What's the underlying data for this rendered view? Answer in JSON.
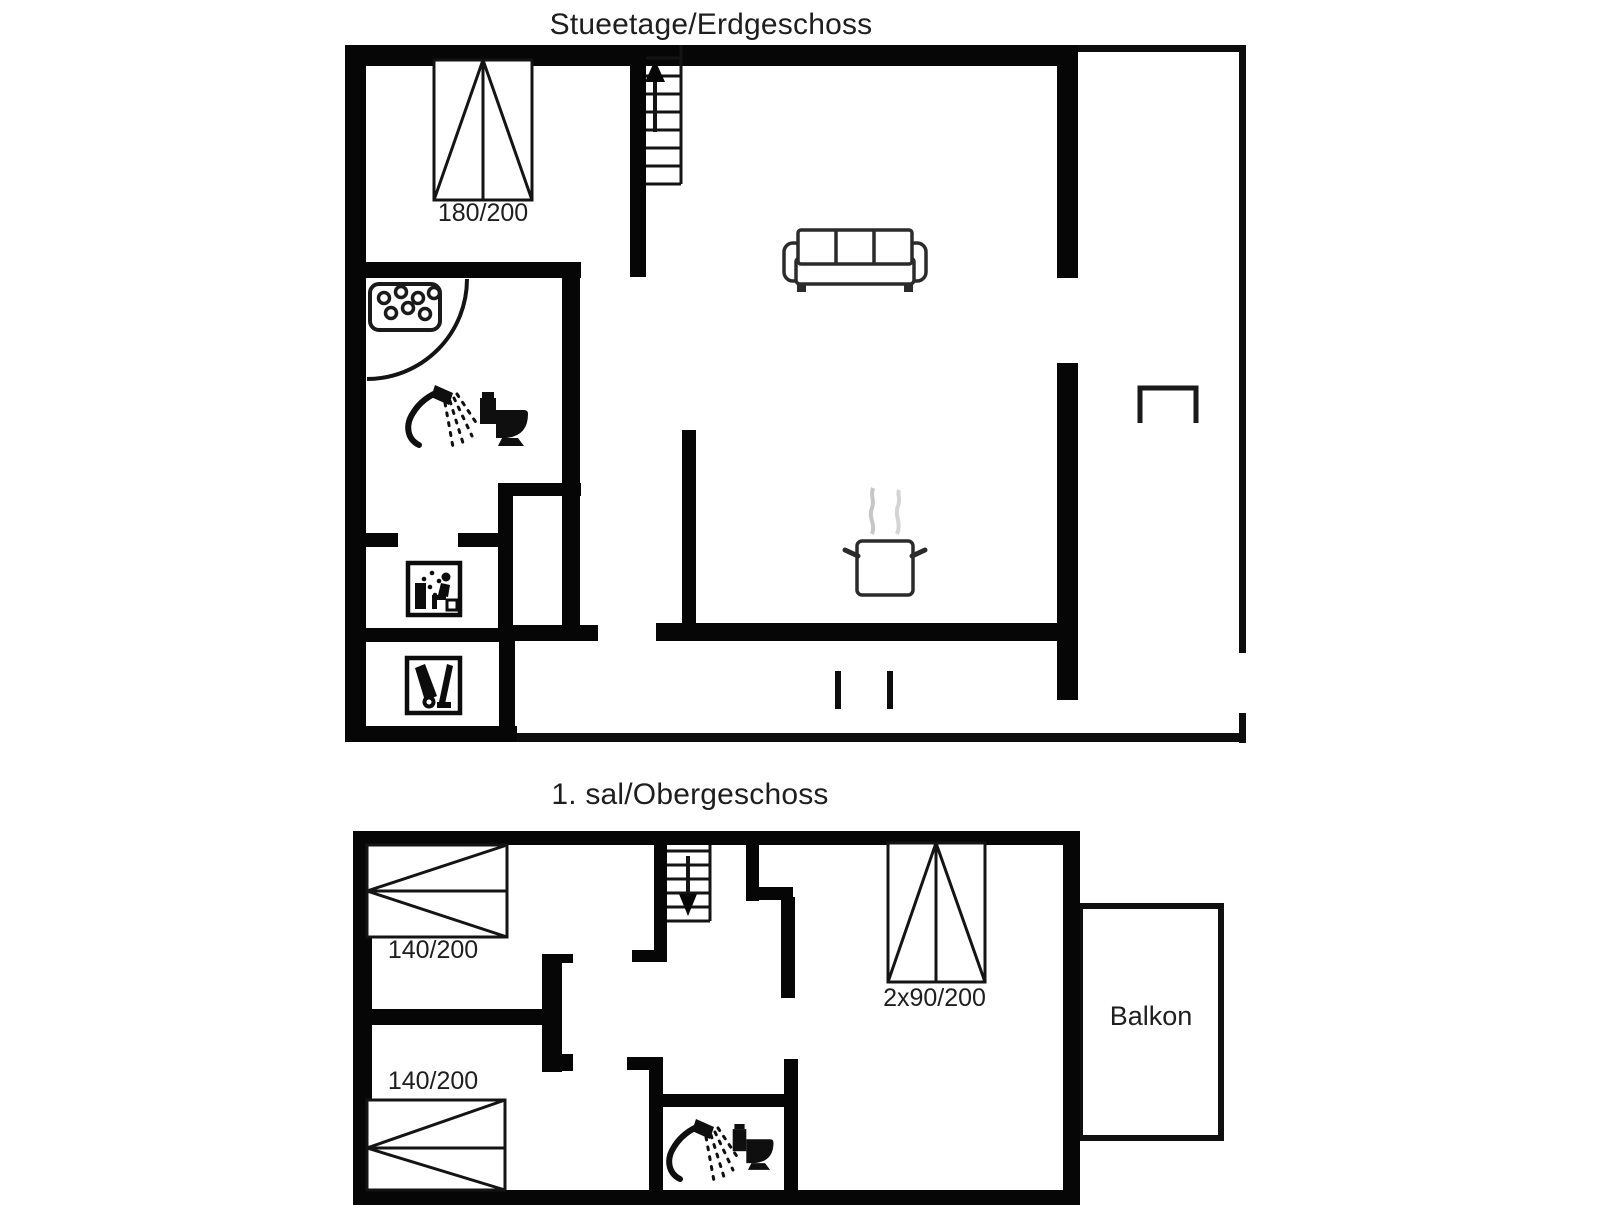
{
  "page": {
    "background": "#ffffff",
    "image_size": "1606x1205",
    "kind": "floor-plan"
  },
  "colors": {
    "wall": "#060606",
    "thin_line": "#0d0d0d",
    "text": "#1e1e1e",
    "furniture_outline": "#2b2b2b",
    "steam": "#c6c6c6"
  },
  "floors": {
    "ground": {
      "title": "Stueetage/Erdgeschoss",
      "bed_double": {
        "label": "180/200"
      },
      "icons": [
        "stairs-up-icon",
        "double-bed-icon",
        "whirlpool-tub-icon",
        "hand-shower-icon",
        "toilet-icon",
        "sauna-icon",
        "vacuum-cleaner-icon",
        "sofa-icon",
        "cooking-pot-icon",
        "bench-icon",
        "door-swing-arc",
        "door-posts"
      ]
    },
    "upper": {
      "title": "1. sal/Obergeschoss",
      "bed_140_top": {
        "label": "140/200"
      },
      "bed_140_bottom": {
        "label": "140/200"
      },
      "bed_2x90": {
        "label": "2x90/200"
      },
      "balcony": {
        "label": "Balkon"
      },
      "icons": [
        "stairs-down-icon",
        "double-bed-icon",
        "two-single-beds-icon",
        "hand-shower-icon",
        "toilet-icon"
      ]
    }
  }
}
